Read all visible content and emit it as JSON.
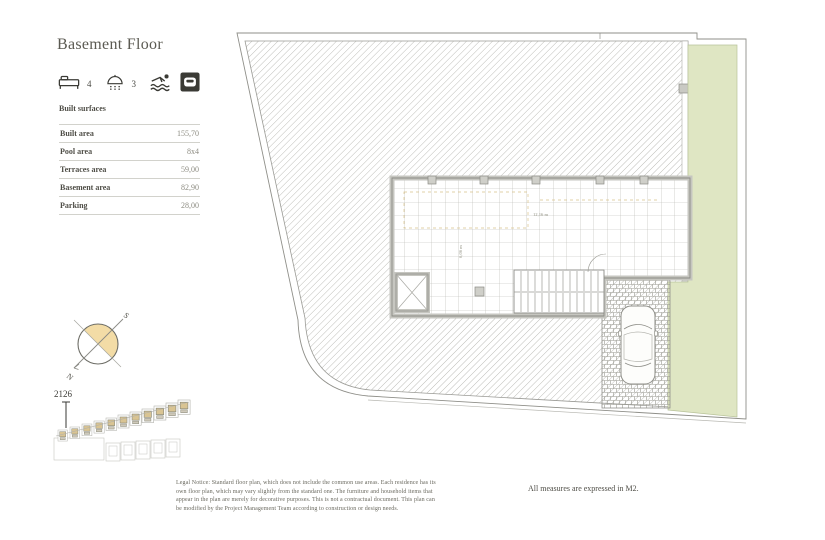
{
  "header": {
    "title": "Basement Floor"
  },
  "amenities": {
    "bedrooms_count": "4",
    "bathrooms_count": "3"
  },
  "built_surfaces": {
    "heading": "Built surfaces",
    "rows": [
      {
        "label": "Built area",
        "value": "155,70"
      },
      {
        "label": "Pool area",
        "value": "8x4"
      },
      {
        "label": "Terraces area",
        "value": "59,00"
      },
      {
        "label": "Basement area",
        "value": "82,90"
      },
      {
        "label": "Parking",
        "value": "28,00"
      }
    ]
  },
  "compass": {
    "north": "N",
    "south": "S"
  },
  "site_plan": {
    "unit_number": "2126"
  },
  "floor_plan": {
    "width_dimension": "12,16 m",
    "depth_dimension": "6,06 m"
  },
  "footer": {
    "legal_notice": "Legal Notice: Standard floor plan, which does not include the common use areas. Each residence has its own floor plan, which may vary slightly from the standard one. The furniture and household items that appear in the plan are merely for decorative purposes. This is not a contractual document. This plan can be modified by the Project Management Team according to construction or design needs.",
    "measures_note": "All measures are expressed in M2."
  },
  "colors": {
    "garden_green": "#dfe6c3",
    "compass_tan": "#f3dca6",
    "ink": "#55544d"
  }
}
